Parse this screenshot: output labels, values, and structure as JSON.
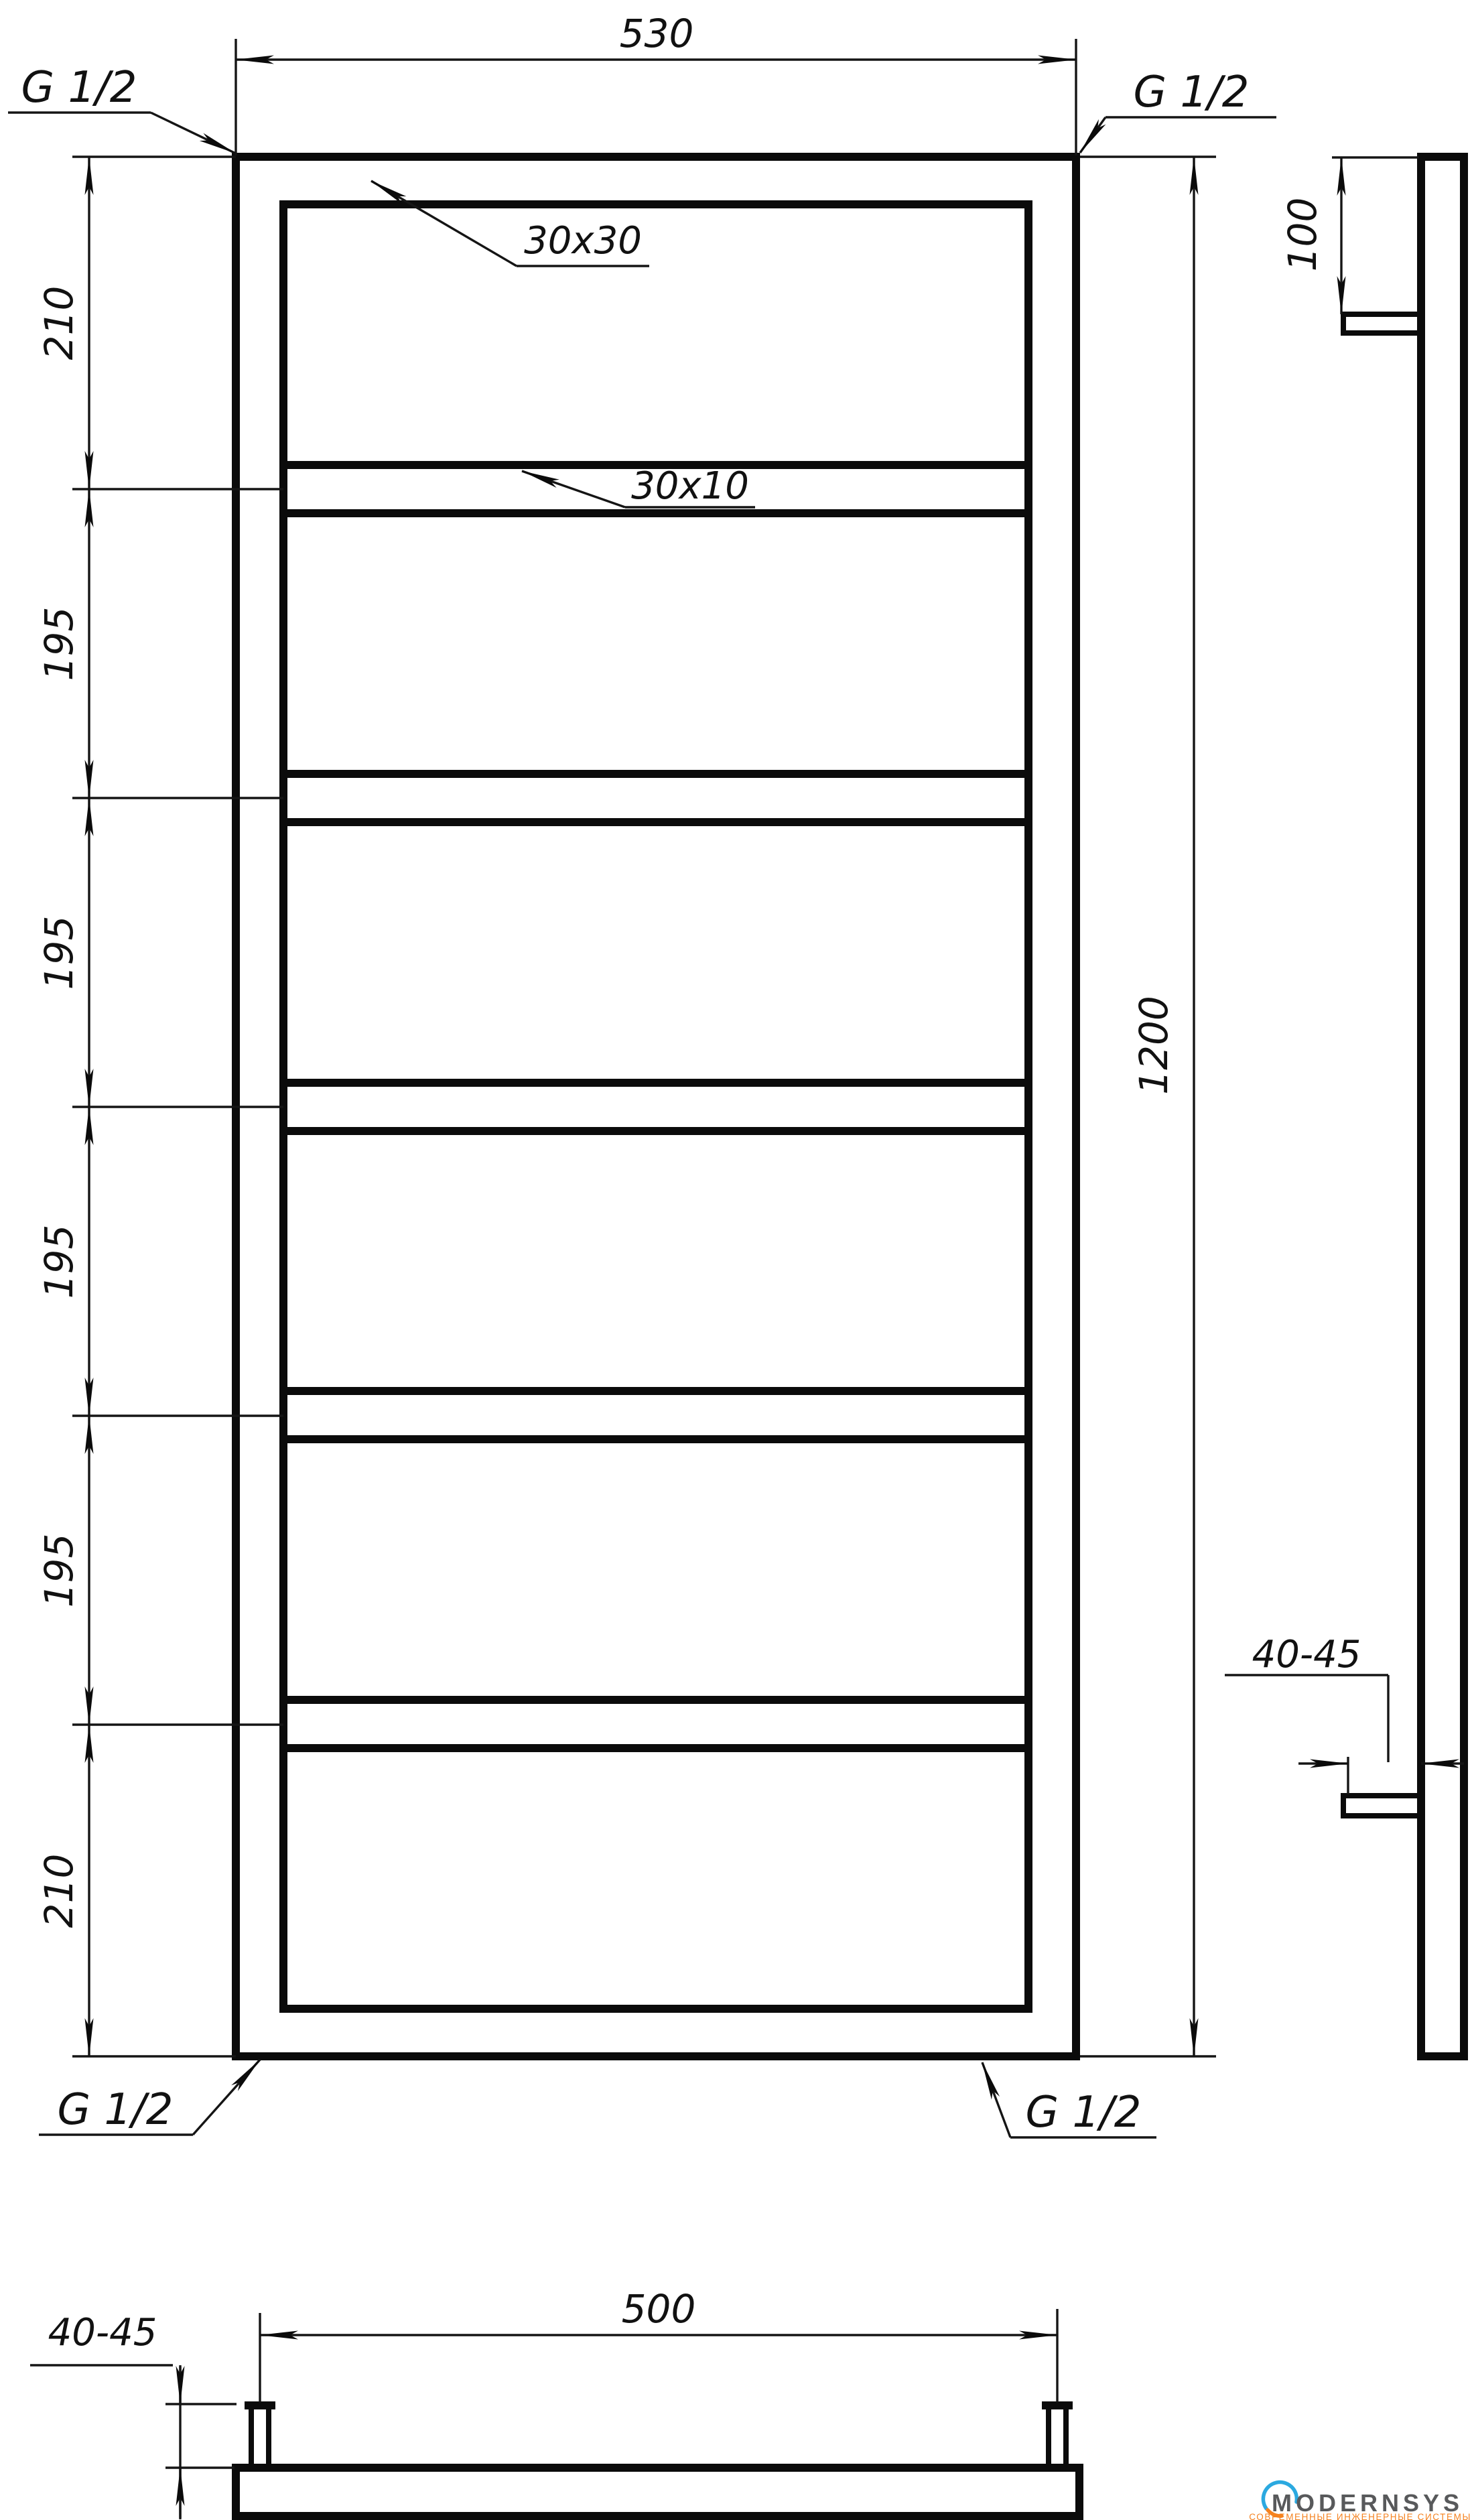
{
  "drawing": {
    "threads": {
      "top_left": "G 1/2",
      "top_right": "G 1/2",
      "bottom_left": "G 1/2",
      "bottom_right": "G 1/2"
    },
    "profiles": {
      "frame": "30x30",
      "rung": "30x10"
    },
    "dims": {
      "width": "530",
      "height": "1200",
      "top_offset": "100",
      "left_chain": [
        "210",
        "195",
        "195",
        "195",
        "195",
        "210"
      ],
      "bracket_offset_side": "40-45",
      "bracket_offset_bottom": "40-45",
      "bracket_spacing": "500"
    }
  },
  "logo": {
    "name": "MODERNSYS",
    "tagline": "СОВРЕМЕННЫЕ ИНЖЕНЕРНЫЕ СИСТЕМЫ",
    "colors": {
      "blue": "#2BA9E0",
      "orange": "#F5821F",
      "text": "#58595B"
    }
  }
}
